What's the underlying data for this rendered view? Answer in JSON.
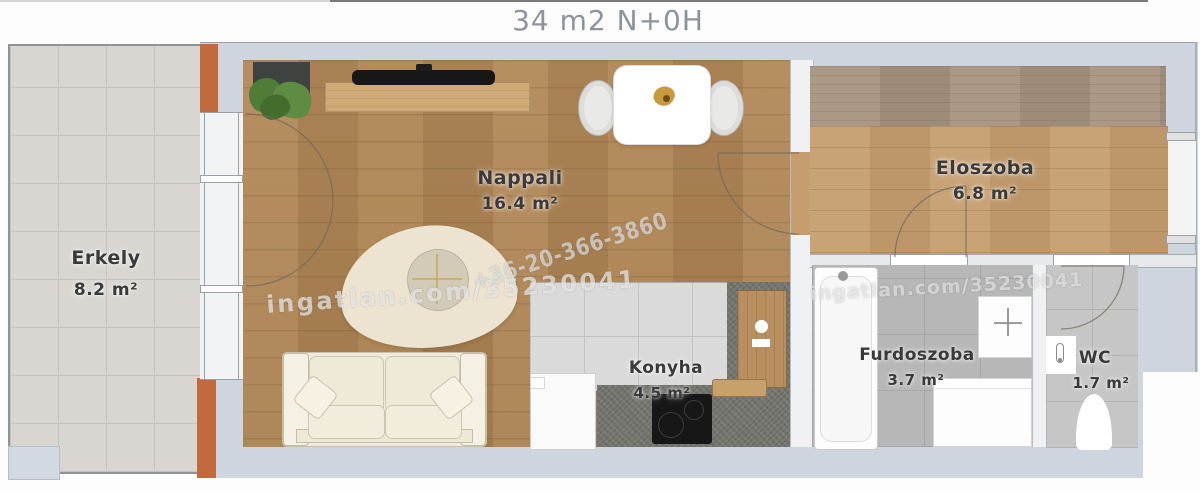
{
  "title": "34 m2 N+0H",
  "rooms": {
    "erkely": {
      "name": "Erkely",
      "area": "8.2 m²"
    },
    "nappali": {
      "name": "Nappali",
      "area": "16.4 m²"
    },
    "eloszoba": {
      "name": "Eloszoba",
      "area": "6.8 m²"
    },
    "konyha": {
      "name": "Konyha",
      "area": "4.5 m²"
    },
    "furdoszoba": {
      "name": "Furdoszoba",
      "area": "3.7 m²"
    },
    "wc": {
      "name": "WC",
      "area": "1.7 m²"
    }
  },
  "watermarks": {
    "site_left": "ingatlan.com/35230041",
    "phone": "+36-20-366-3860",
    "site_right": "ingatlan.com/35230041"
  },
  "colors": {
    "wall": "#ced5df",
    "wall_light": "#f0f1f3",
    "outline": "#9aa0a7",
    "balcony_tile": "#d9d6d1",
    "balcony_line": "#c6c3be",
    "orange_wall": "#c16b3d",
    "living_wood": "#b28858",
    "hall_wood": "#c59d6e",
    "wardrobe_wood": "#a7947f",
    "kitchen_tile": "#dadada",
    "counter": "#74746e",
    "bath_tile": "#b7b7b7",
    "wc_tile": "#c6c6c6",
    "label": "#3a3a3a",
    "title": "#8d939d",
    "accent_gold": "#c79a3f",
    "rug_cream": "#ece4d0",
    "sofa_cream": "#f0ebdc",
    "watermark": "rgba(255,255,255,0.6)"
  }
}
